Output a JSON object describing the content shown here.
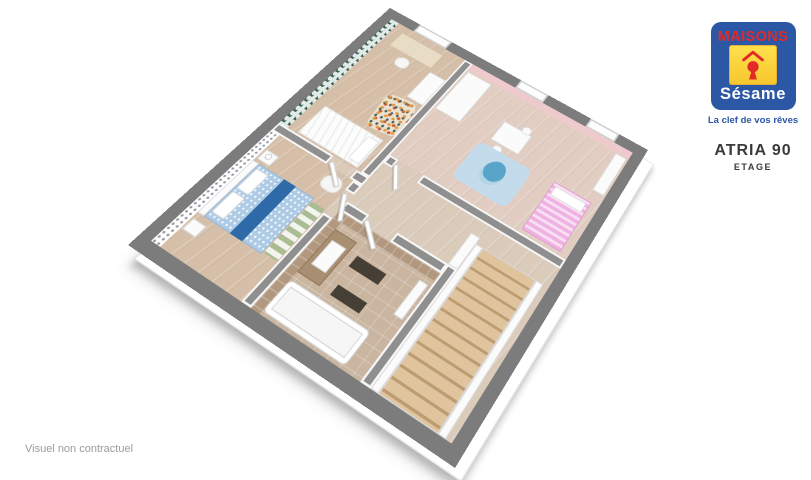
{
  "branding": {
    "brand_top": "MAISONS",
    "brand_bottom": "Sésame",
    "tagline": "La clef de vos rêves",
    "colors": {
      "blue": "#2b57a5",
      "red": "#e22a28",
      "yellow": "#ffd91e"
    }
  },
  "plan_title": {
    "model": "ATRIA 90",
    "level": "ETAGE"
  },
  "footer": {
    "disclaimer": "Visuel non contractuel"
  },
  "floorplan": {
    "view": "3d-isometric-cutaway",
    "palette": {
      "outer_wall": "#7c7c7c",
      "interior_wall": "#8f8f8f",
      "wood_floor": "#d6bfa8",
      "hall_floor": "#dacbbb",
      "kids_floor": "#e1cdc1",
      "bath_floor": "#c9b5a0",
      "teal_wallpaper": "#3e6156",
      "pink_wall": "#eecacd",
      "blue_bed": "#aecbe6",
      "navy_runner": "#2e6aa8",
      "pink_bed": "#efb2e2",
      "stair_wood": "#dec29b"
    },
    "rooms": [
      "bedroom-office",
      "kids-bedroom",
      "master-bedroom",
      "bathroom",
      "landing",
      "staircase"
    ],
    "items": [
      {
        "n": "floor-landing",
        "c": "wood",
        "x": 13,
        "y": 13,
        "w": 334,
        "h": 334,
        "bg": "#dacbbb"
      },
      {
        "n": "floor-bedroom-office",
        "c": "wood",
        "x": 13,
        "y": 13,
        "w": 107,
        "h": 179,
        "bg": "#d6bfa8"
      },
      {
        "n": "floor-kids-bedroom",
        "c": "wood",
        "x": 131,
        "y": 13,
        "w": 216,
        "h": 147,
        "bg": "#e1cdc1"
      },
      {
        "n": "floor-master-bedroom",
        "c": "wood",
        "x": 13,
        "y": 203,
        "w": 107,
        "h": 144,
        "bg": "#d6bfa8"
      },
      {
        "n": "floor-bathroom",
        "c": "tilefloor",
        "x": 131,
        "y": 235,
        "w": 121,
        "h": 112,
        "bg": "#c9b5a0"
      },
      {
        "n": "wallpaper-teal-triangles",
        "c": "pat-teal",
        "x": 13,
        "y": 13,
        "w": 11,
        "h": 179
      },
      {
        "n": "wallpaper-houndstooth",
        "c": "pat-hound",
        "x": 13,
        "y": 203,
        "w": 11,
        "h": 144
      },
      {
        "n": "wallpaper-pink",
        "c": "",
        "x": 131,
        "y": 13,
        "w": 216,
        "h": 10,
        "bg": "#eecacd"
      },
      {
        "n": "wallpaper-bath-tile-west",
        "c": "pat-tile",
        "x": 131,
        "y": 235,
        "w": 10,
        "h": 112
      },
      {
        "n": "wallpaper-bath-tile-north",
        "c": "pat-tile",
        "x": 131,
        "y": 235,
        "w": 121,
        "h": 9
      },
      {
        "n": "desk",
        "c": "wood-furn",
        "x": 36,
        "y": 22,
        "w": 60,
        "h": 24,
        "bg": "#e9dcc6"
      },
      {
        "n": "desk-chair",
        "c": "chair",
        "x": 56,
        "y": 50,
        "w": 17,
        "h": 15,
        "bg": "#f6f6f4"
      },
      {
        "n": "mosaic-rug",
        "c": "rug-mosaic",
        "x": 82,
        "y": 96,
        "w": 38,
        "h": 48,
        "rot": -8
      },
      {
        "n": "single-bed",
        "c": "bed-white",
        "x": 36,
        "y": 150,
        "w": 78,
        "h": 40
      },
      {
        "n": "single-bed-pillow",
        "c": "pillow",
        "x": 98,
        "y": 154,
        "w": 14,
        "h": 32
      },
      {
        "n": "wardrobe-office",
        "c": "white",
        "x": 98,
        "y": 50,
        "w": 22,
        "h": 42
      },
      {
        "n": "wardrobe-kids",
        "c": "white",
        "x": 133,
        "y": 25,
        "w": 33,
        "h": 62
      },
      {
        "n": "kids-table",
        "c": "white",
        "x": 206,
        "y": 58,
        "w": 36,
        "h": 28
      },
      {
        "n": "kids-chair-1",
        "c": "chair",
        "x": 214,
        "y": 88,
        "w": 11,
        "h": 10,
        "bg": "#fafafa"
      },
      {
        "n": "kids-chair-2",
        "c": "chair",
        "x": 228,
        "y": 50,
        "w": 11,
        "h": 10,
        "bg": "#fafafa"
      },
      {
        "n": "kids-rug",
        "c": "rug-blue",
        "x": 198,
        "y": 94,
        "w": 68,
        "h": 52
      },
      {
        "n": "owl-toy",
        "c": "owl",
        "x": 220,
        "y": 104,
        "w": 24,
        "h": 30,
        "rot": 12
      },
      {
        "n": "kids-bed",
        "c": "bed-pink",
        "x": 292,
        "y": 92,
        "w": 46,
        "h": 64
      },
      {
        "n": "kids-bed-pillow",
        "c": "pillow",
        "x": 296,
        "y": 96,
        "w": 38,
        "h": 12
      },
      {
        "n": "kids-shelf",
        "c": "white",
        "x": 331,
        "y": 24,
        "w": 14,
        "h": 54
      },
      {
        "n": "nightstand-north",
        "c": "white",
        "x": 26,
        "y": 222,
        "w": 16,
        "h": 13
      },
      {
        "n": "lamp-north",
        "c": "lamp",
        "x": 30,
        "y": 224,
        "w": 7,
        "h": 7
      },
      {
        "n": "armchair",
        "c": "chair",
        "x": 94,
        "y": 208,
        "w": 22,
        "h": 18,
        "bg": "#f6f6f4"
      },
      {
        "n": "master-headboard",
        "c": "white",
        "x": 24,
        "y": 238,
        "w": 8,
        "h": 68
      },
      {
        "n": "master-bed",
        "c": "bed-blue",
        "x": 32,
        "y": 238,
        "w": 70,
        "h": 68
      },
      {
        "n": "master-bed-runner",
        "c": "runner",
        "x": 64,
        "y": 238,
        "w": 15,
        "h": 68
      },
      {
        "n": "master-pillow-1",
        "c": "pillow",
        "x": 34,
        "y": 243,
        "w": 15,
        "h": 26
      },
      {
        "n": "master-pillow-2",
        "c": "pillow",
        "x": 34,
        "y": 273,
        "w": 15,
        "h": 26
      },
      {
        "n": "nightstand-south",
        "c": "white",
        "x": 26,
        "y": 312,
        "w": 16,
        "h": 13
      },
      {
        "n": "chevron-rug",
        "c": "rug-chevron",
        "x": 103,
        "y": 242,
        "w": 16,
        "h": 62
      },
      {
        "n": "vanity",
        "c": "vanity",
        "x": 141,
        "y": 252,
        "w": 26,
        "h": 50
      },
      {
        "n": "vanity-basin",
        "c": "white",
        "x": 146,
        "y": 262,
        "w": 17,
        "h": 28
      },
      {
        "n": "bath-mat-1",
        "c": "dark",
        "x": 176,
        "y": 262,
        "w": 34,
        "h": 12
      },
      {
        "n": "bath-mat-2",
        "c": "dark",
        "x": 180,
        "y": 292,
        "w": 33,
        "h": 11
      },
      {
        "n": "bathtub",
        "c": "tub",
        "x": 141,
        "y": 310,
        "w": 92,
        "h": 34
      },
      {
        "n": "towel-radiator",
        "c": "white",
        "x": 239,
        "y": 250,
        "w": 10,
        "h": 38
      },
      {
        "n": "stair-railing",
        "c": "white",
        "x": 252,
        "y": 186,
        "w": 11,
        "h": 38
      },
      {
        "n": "stair-stringer-west",
        "c": "white",
        "x": 263,
        "y": 193,
        "w": 8,
        "h": 154
      },
      {
        "n": "staircase-steps",
        "c": "stairs",
        "x": 271,
        "y": 193,
        "w": 62,
        "h": 154
      },
      {
        "n": "stair-stringer-east",
        "c": "white",
        "x": 333,
        "y": 193,
        "w": 8,
        "h": 154
      },
      {
        "n": "wall-office-kids",
        "c": "wall",
        "x": 120,
        "y": 13,
        "w": 11,
        "h": 179
      },
      {
        "n": "wall-office-south-a",
        "c": "wall",
        "x": 13,
        "y": 192,
        "w": 72,
        "h": 11
      },
      {
        "n": "wall-office-south-b",
        "c": "wall",
        "x": 115,
        "y": 192,
        "w": 16,
        "h": 11
      },
      {
        "n": "wall-hall-west-a",
        "c": "wall",
        "x": 120,
        "y": 203,
        "w": 11,
        "h": 12
      },
      {
        "n": "wall-hall-west-b",
        "c": "wall",
        "x": 120,
        "y": 245,
        "w": 11,
        "h": 102
      },
      {
        "n": "wall-kids-south-a",
        "c": "wall",
        "x": 131,
        "y": 160,
        "w": 11,
        "h": 11
      },
      {
        "n": "wall-kids-south-b",
        "c": "wall",
        "x": 174,
        "y": 160,
        "w": 173,
        "h": 11
      },
      {
        "n": "wall-bath-north-a",
        "c": "wall",
        "x": 131,
        "y": 224,
        "w": 27,
        "h": 11
      },
      {
        "n": "wall-bath-north-b",
        "c": "wall",
        "x": 192,
        "y": 224,
        "w": 60,
        "h": 11
      },
      {
        "n": "wall-bath-east",
        "c": "wall",
        "x": 252,
        "y": 224,
        "w": 11,
        "h": 123
      },
      {
        "n": "window-office",
        "c": "window",
        "x": 45,
        "y": 0,
        "w": 47,
        "h": 13
      },
      {
        "n": "window-kids-1",
        "c": "window",
        "x": 190,
        "y": 0,
        "w": 38,
        "h": 13
      },
      {
        "n": "window-kids-2",
        "c": "window",
        "x": 285,
        "y": 0,
        "w": 38,
        "h": 13
      },
      {
        "n": "door-office",
        "c": "door",
        "x": 88,
        "y": 196,
        "w": 30,
        "h": 5,
        "rot": 38
      },
      {
        "n": "door-master",
        "c": "door",
        "x": 123,
        "y": 216,
        "w": 30,
        "h": 5,
        "rot": 58
      },
      {
        "n": "door-kids",
        "c": "door",
        "x": 143,
        "y": 163,
        "w": 30,
        "h": 5,
        "rot": 52
      },
      {
        "n": "door-bathroom",
        "c": "door",
        "x": 159,
        "y": 227,
        "w": 32,
        "h": 5,
        "rot": 38
      }
    ]
  }
}
